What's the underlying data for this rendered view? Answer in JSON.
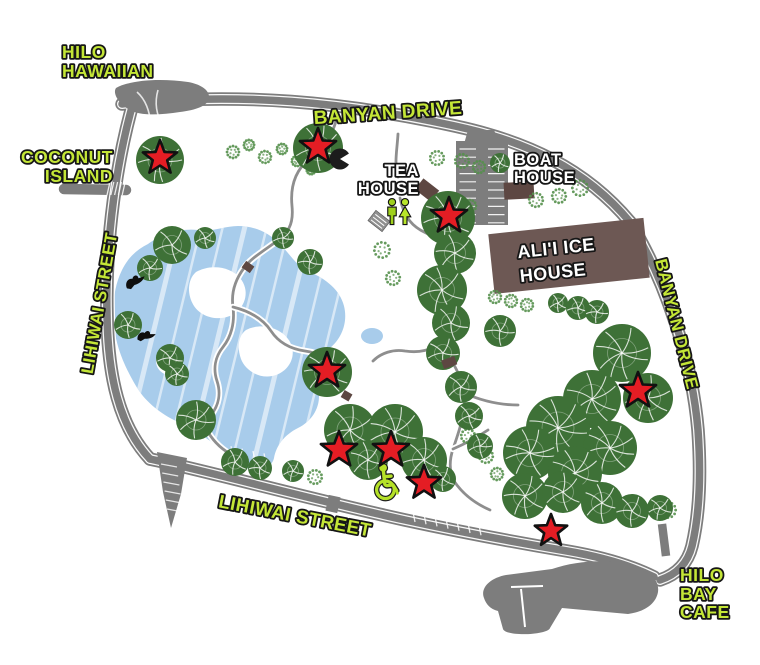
{
  "labels": {
    "hilo_hawaiian_1": "HILO",
    "hilo_hawaiian_2": "HAWAIIAN",
    "coconut_island_1": "COCONUT",
    "coconut_island_2": "ISLAND",
    "banyan_drive_top": "BANYAN DRIVE",
    "banyan_drive_right": "BANYAN DRIVE",
    "lihiwai_street_left": "LIHIWAI STREET",
    "lihiwai_street_bottom": "LIHIWAI STREET",
    "tea_house_1": "TEA",
    "tea_house_2": "HOUSE",
    "boat_house_1": "BOAT",
    "boat_house_2": "HOUSE",
    "alii_ice_house_1": "ALI'I ICE",
    "alii_ice_house_2": "HOUSE",
    "hilo_bay_cafe_1": "HILO",
    "hilo_bay_cafe_2": "BAY",
    "hilo_bay_cafe_3": "CAFE"
  },
  "markers": {
    "star_color": "#e41d24",
    "stars": [
      {
        "x": 160,
        "y": 158,
        "r": 18
      },
      {
        "x": 318,
        "y": 147,
        "r": 19
      },
      {
        "x": 449,
        "y": 216,
        "r": 19
      },
      {
        "x": 327,
        "y": 371,
        "r": 19
      },
      {
        "x": 638,
        "y": 391,
        "r": 19
      },
      {
        "x": 339,
        "y": 450,
        "r": 19
      },
      {
        "x": 391,
        "y": 450,
        "r": 19
      },
      {
        "x": 424,
        "y": 483,
        "r": 18
      },
      {
        "x": 551,
        "y": 531,
        "r": 17
      }
    ]
  },
  "icons": {
    "restroom": "restroom-icon",
    "wheelchair": "wheelchair-accessible-icon",
    "pavilion": "pavilion-icon",
    "bird": "bird-icon"
  },
  "colors": {
    "label_green": "#c4e637",
    "label_white": "#ffffff",
    "road_gray": "#7d7d7d",
    "path_gray": "#8e8e8e",
    "pond_blue": "#a8cceb",
    "tree_green": "#3e7137",
    "bush_green": "#55904c",
    "building_brown": "#6d5854",
    "building_brown_small": "#5d4742",
    "star_red": "#e41d24"
  }
}
